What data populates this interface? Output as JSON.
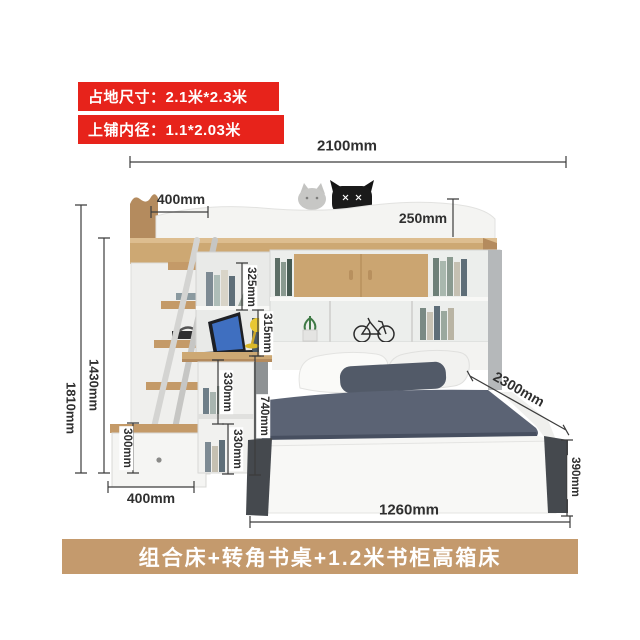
{
  "badges": {
    "floor_size": "占地尺寸：2.1米*2.3米",
    "upper_inner_size": "上铺内径：1.1*2.03米"
  },
  "banner": {
    "title": "组合床+转角书桌+1.2米书柜高箱床"
  },
  "dimensions": {
    "total_width": "2100mm",
    "ladder_depth_top": "400mm",
    "guard_rail_height": "250mm",
    "total_height": "1810mm",
    "under_bunk_height": "1430mm",
    "drawer_height": "300mm",
    "ladder_width_bottom": "400mm",
    "shelf_top_height": "325mm",
    "shelf_mid_height": "315mm",
    "cube_upper_height": "330mm",
    "desk_height": "740mm",
    "cube_lower_height": "330mm",
    "bed_length": "2300mm",
    "storage_box_height": "390mm",
    "bed_front_width": "1260mm"
  },
  "colors": {
    "badge_red": "#e7231b",
    "banner_tan": "#c49a6d",
    "wood": "#cda873",
    "wood_dark": "#b48b5e",
    "panel_white": "#f4f4f2",
    "side_gray": "#b5b8ba",
    "post_dark": "#45494e",
    "blanket_gray": "#5b6374",
    "dim_line": "#3c3c3c"
  }
}
